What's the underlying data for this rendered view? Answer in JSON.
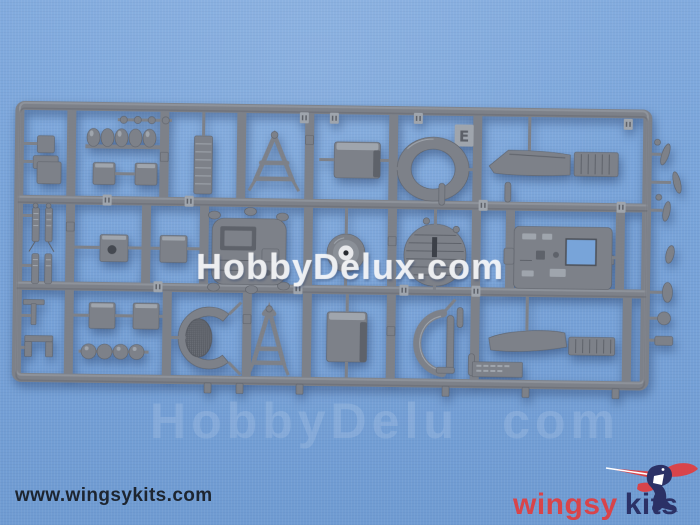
{
  "watermarks": {
    "center": "HobbyDelux.com",
    "faint_left": "HobbyDelu",
    "faint_right": "com"
  },
  "sprue": {
    "letter_tab": "E"
  },
  "footer": {
    "website_url": "www.wingsykits.com",
    "brand_word_red": "wingsy",
    "brand_word_navy": "kits",
    "logo_icon": "hummingbird-icon"
  },
  "colors": {
    "background-blue": "#78a4d9",
    "sprue-gray": "#7d8189",
    "sprue-gray-dark": "#5e626a",
    "sprue-gray-light": "#9fa5ad",
    "brand-red": "#d8444a",
    "brand-navy": "#2b3166",
    "url-text": "#1d2530",
    "watermark-white": "rgba(255,255,255,0.62)"
  }
}
